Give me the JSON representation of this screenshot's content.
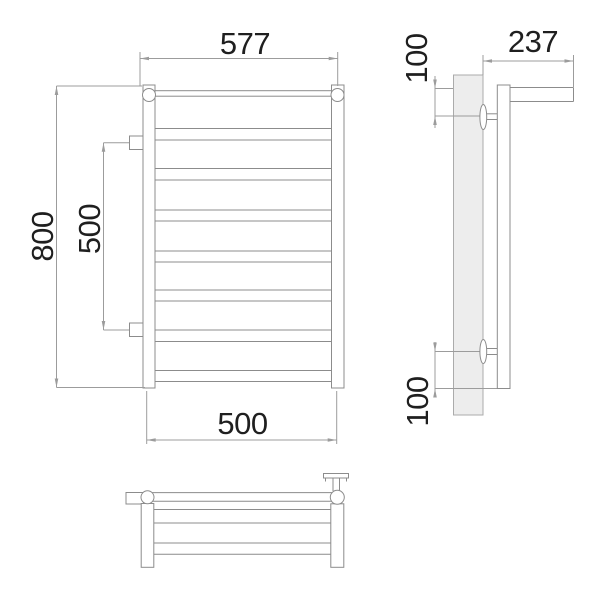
{
  "dimensions": {
    "front": {
      "overall_width": "577",
      "overall_height": "800",
      "bracket_spacing": "500",
      "rail_width": "500"
    },
    "side": {
      "depth": "237",
      "top_bracket_offset": "100",
      "bottom_bracket_offset": "100"
    }
  },
  "colors": {
    "bg": "#ffffff",
    "line": "#8c8c8c",
    "dim": "#9c9c9c",
    "ink": "#1f1f1f",
    "wall-fill": "#ededed",
    "wall-border": "#ababab"
  }
}
